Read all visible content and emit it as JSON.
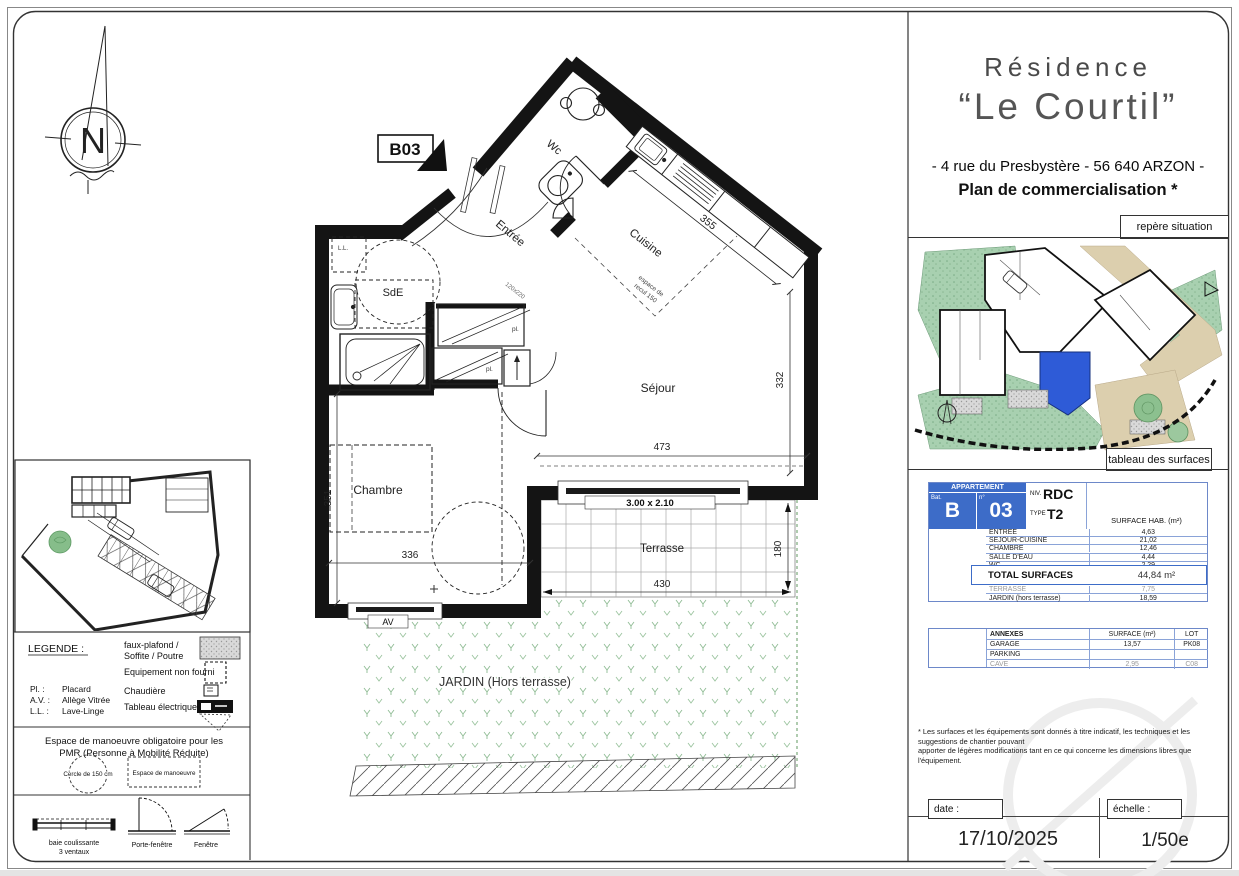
{
  "sheet": {
    "unit_tag": "B03",
    "compass_letter": "N"
  },
  "rooms": {
    "wc": "Wc",
    "entree": "Entrée",
    "cuisine": "Cuisine",
    "sde": "SdE",
    "sejour": "Séjour",
    "chambre": "Chambre",
    "terrasse": "Terrasse",
    "jardin": "JARDIN (Hors terrasse)",
    "ll": "L.L."
  },
  "dimensions": {
    "kitchen": "355",
    "sejour_side": "332",
    "sejour_width": "473",
    "chambre_side": "351",
    "chambre_width": "336",
    "terrasse_width": "430",
    "terrasse_side": "180",
    "bay": "3.00 x 2.10",
    "av": "AV",
    "door": "120x220",
    "recul1": "espace de",
    "recul2": "recul 150",
    "pl": "pl."
  },
  "title_block": {
    "residence": "Résidence",
    "name": "“Le Courtil”",
    "address": "- 4 rue du Presbystère - 56 640 ARZON -",
    "plan_type": "Plan de commercialisation *",
    "repere": "repère situation",
    "tableau": "tableau des surfaces"
  },
  "surface_table": {
    "appartement": "APPARTEMENT",
    "bat_label": "Bat.",
    "num_label": "n°",
    "bat": "B",
    "num": "03",
    "niv_label": "NIV.",
    "niv": "RDC",
    "type_label": "TYPE",
    "type": "T2",
    "surface_hab": "SURFACE HAB. (m²)",
    "rows": [
      {
        "label": "ENTREE",
        "value": "4,63"
      },
      {
        "label": "SEJOUR-CUISINE",
        "value": "21,02"
      },
      {
        "label": "CHAMBRE",
        "value": "12,46"
      },
      {
        "label": "SALLE D'EAU",
        "value": "4,44"
      },
      {
        "label": "WC",
        "value": "2,29"
      }
    ],
    "total_label": "TOTAL SURFACES",
    "total_value": "44,84 m²",
    "outdoor_rows": [
      {
        "label": "TERRASSE",
        "value": "7,75"
      },
      {
        "label": "JARDIN (hors terrasse)",
        "value": "18,59"
      }
    ],
    "annexes": {
      "title": "ANNEXES",
      "surface_header": "SURFACE (m²)",
      "lot_header": "LOT",
      "rows": [
        {
          "label": "GARAGE",
          "surface": "13,57",
          "lot": "PK08"
        },
        {
          "label": "PARKING",
          "surface": "",
          "lot": ""
        },
        {
          "label": "CAVE",
          "surface": "2,95",
          "lot": "C08"
        }
      ]
    }
  },
  "legend": {
    "title": "LEGENDE :",
    "pl_abbr": "Pl. :",
    "pl_label": "Placard",
    "av_abbr": "A.V. :",
    "av_label": "Allège Vitrée",
    "ll_abbr": "L.L. :",
    "ll_label": "Lave-Linge",
    "faux1": "faux-plafond /",
    "faux2": "Soffite / Poutre",
    "equip": "Equipement non fourni",
    "chaudiere": "Chaudière",
    "tableau_elec": "Tableau électrique",
    "pmr1": "Espace de manoeuvre obligatoire pour les",
    "pmr2": "PMR (Personne à Mobilité Réduite)",
    "cercle": "Cercle de 150 cm",
    "espace": "Espace de manoeuvre",
    "baie1": "baie coulissante",
    "baie2": "3 ventaux",
    "porte": "Porte-fenêtre",
    "fenetre": "Fenêtre"
  },
  "footer": {
    "footnote1": "* Les surfaces et les équipements sont donnés à titre indicatif, les techniques et les suggestions de chantier pouvant",
    "footnote2": "apporter de légères modifications tant en ce qui concerne les dimensions libres que l'équipement.",
    "date_label": "date :",
    "date_value": "17/10/2025",
    "scale_label": "échelle :",
    "scale_value": "1/50e"
  },
  "colors": {
    "table_blue": "#3d6cc8",
    "unit_blue": "#2e5bd7",
    "site_green": "#a8d0b0",
    "site_tan": "#dccfae",
    "jardin_mark": "#8fbc94"
  }
}
